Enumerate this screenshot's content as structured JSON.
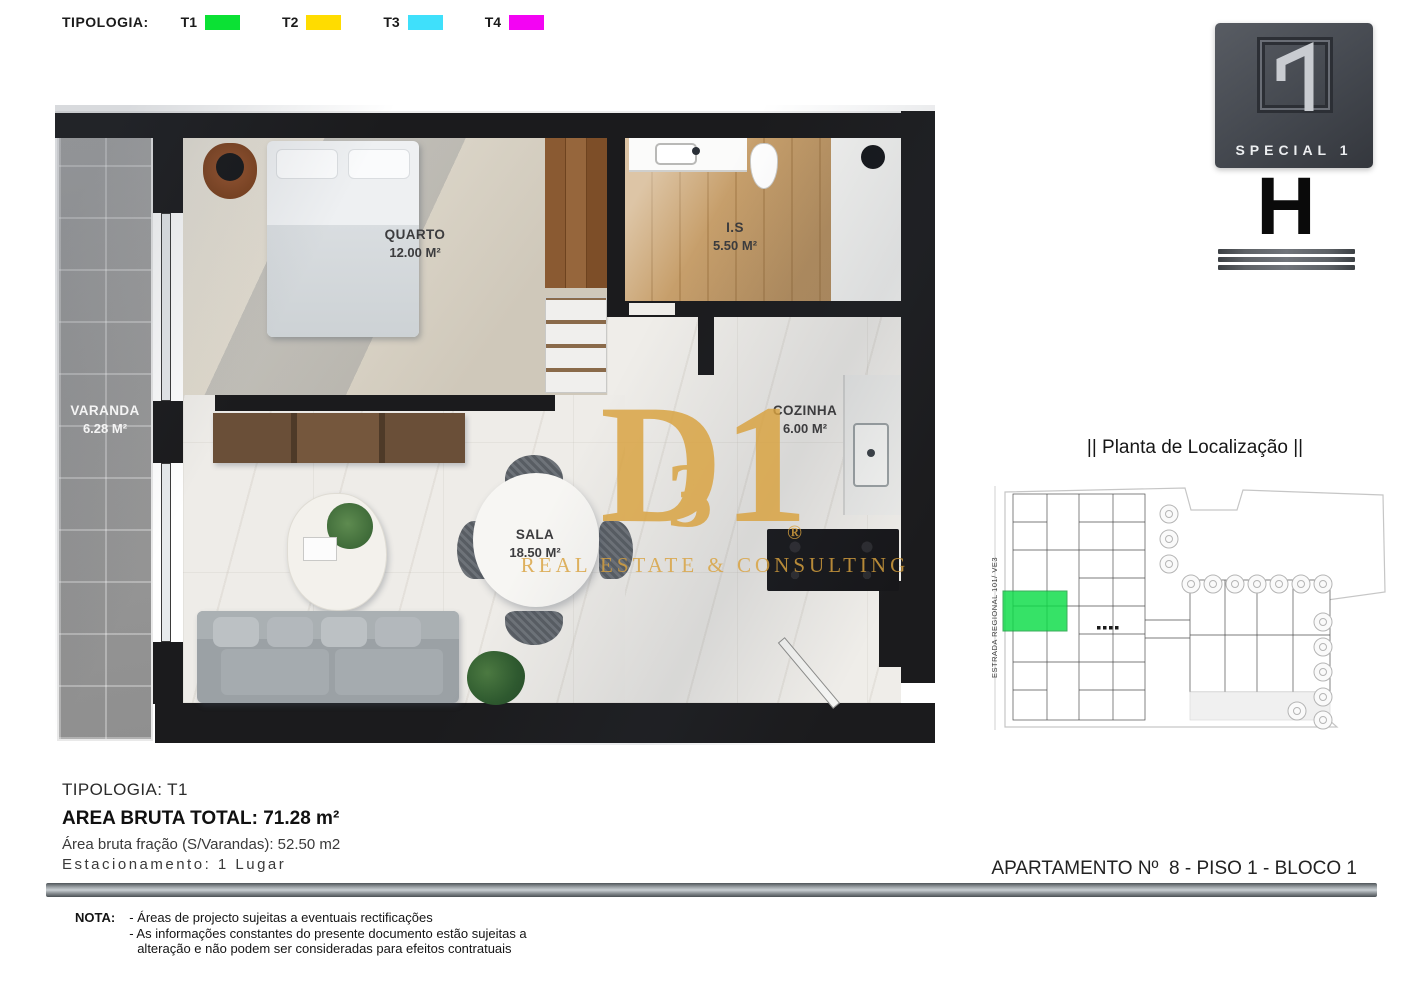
{
  "legend": {
    "label": "TIPOLOGIA:",
    "items": [
      {
        "label": "T1",
        "color": "#0BE134"
      },
      {
        "label": "T2",
        "color": "#FFDC00"
      },
      {
        "label": "T3",
        "color": "#3FE0FB"
      },
      {
        "label": "T4",
        "color": "#F304F3"
      }
    ]
  },
  "floor_plan": {
    "rooms": [
      {
        "name": "QUARTO",
        "area": "12.00 M²"
      },
      {
        "name": "I.S",
        "area": "5.50 M²"
      },
      {
        "name": "VARANDA",
        "area": "6.28 M²"
      },
      {
        "name": "COZINHA",
        "area": "6.00 M²"
      },
      {
        "name": "SALA",
        "area": "18.50 M²"
      }
    ],
    "watermark": {
      "letter_d": "D",
      "letter_3": "3",
      "letter_1": "1",
      "registered": "®",
      "text": "REAL ESTATE & CONSULTING",
      "color": "#D9A23E"
    }
  },
  "brand": {
    "logo_text": "SPECIAL 1",
    "block_letter": "H"
  },
  "location": {
    "title": "|| Planta de Localização ||",
    "road_label": "ESTRADA REGIONAL 101/ VE3",
    "highlight_color": "#0BDC46"
  },
  "details": {
    "tipologia": "TIPOLOGIA: T1",
    "area_total": "AREA BRUTA TOTAL: 71.28 m²",
    "area_fracao": "Área bruta fração (S/Varandas): 52.50 m2",
    "estacionamento": "Estacionamento: 1 Lugar",
    "apartamento": "APARTAMENTO Nº  8 - PISO 1 - BLOCO 1"
  },
  "nota": {
    "label": "NOTA:",
    "lines": [
      "- Áreas de projecto sujeitas a eventuais rectificações",
      "- As informações constantes do presente documento estão sujeitas a",
      "alteração e não podem ser consideradas para efeitos contratuais"
    ]
  }
}
